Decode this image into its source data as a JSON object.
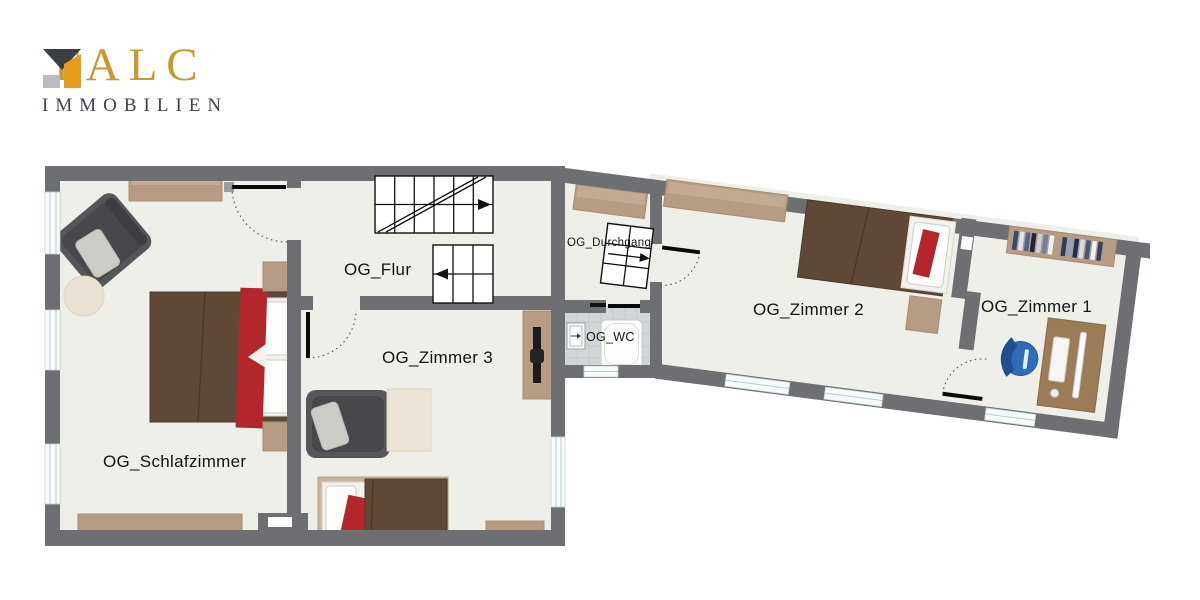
{
  "brand": {
    "name": "FALC",
    "subtitle": "IMMOBILIEN",
    "colors": {
      "gold": "#c9992f",
      "dark": "#3e4450",
      "orange": "#e89c1e",
      "gray": "#b9bcc0",
      "icon_dark": "#3a3f46"
    }
  },
  "floorplan": {
    "rooms": [
      {
        "id": "schlafzimmer",
        "label": "OG_Schlafzimmer"
      },
      {
        "id": "flur",
        "label": "OG_Flur"
      },
      {
        "id": "zimmer3",
        "label": "OG_Zimmer 3"
      },
      {
        "id": "durchgang",
        "label": "OG_Durchgang"
      },
      {
        "id": "wc",
        "label": "OG_WC"
      },
      {
        "id": "zimmer2",
        "label": "OG_Zimmer 2"
      },
      {
        "id": "zimmer1",
        "label": "OG_Zimmer 1"
      }
    ],
    "colors": {
      "wall": "#6e6f72",
      "floor": "#edefe8",
      "wc_floor": "#d3d6d8",
      "window": "#f6fbfb",
      "wood": "#b59c83",
      "wood_dark": "#9c7b57",
      "bed_brown": "#5d4936",
      "mattress": "#f3f1ec",
      "accent_red": "#b3272c",
      "armchair_gray": "#56565a",
      "desk_chair_blue": "#2e6cb5"
    }
  }
}
